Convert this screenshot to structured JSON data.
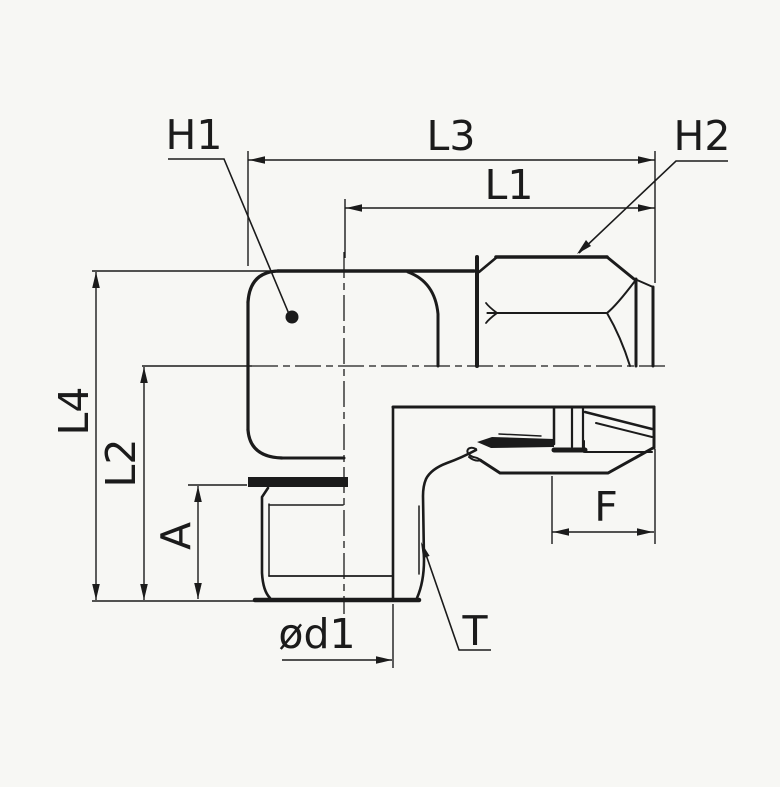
{
  "drawing": {
    "labels": {
      "h1": "H1",
      "l3": "L3",
      "h2": "H2",
      "l1": "L1",
      "l4": "L4",
      "l2": "L2",
      "a": "A",
      "f": "F",
      "phi_d1": "ød1",
      "t": "T"
    },
    "colors": {
      "line": "#1b1b1b",
      "background": "#f7f7f4"
    }
  }
}
